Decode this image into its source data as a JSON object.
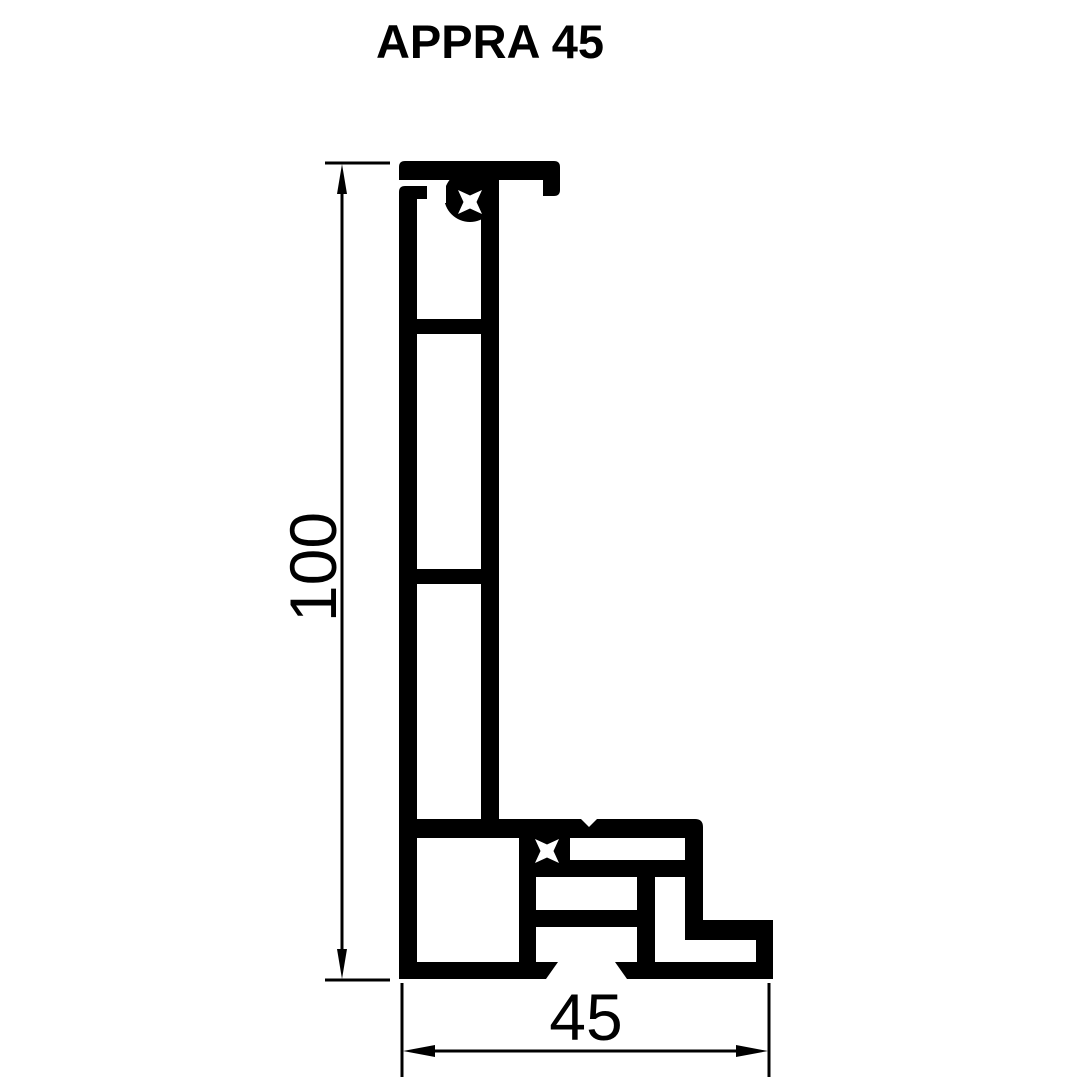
{
  "drawing": {
    "title": "APPRA 45",
    "height_dimension_label": "100",
    "width_dimension_label": "45",
    "line_color": "#000000",
    "background_color": "#ffffff"
  }
}
